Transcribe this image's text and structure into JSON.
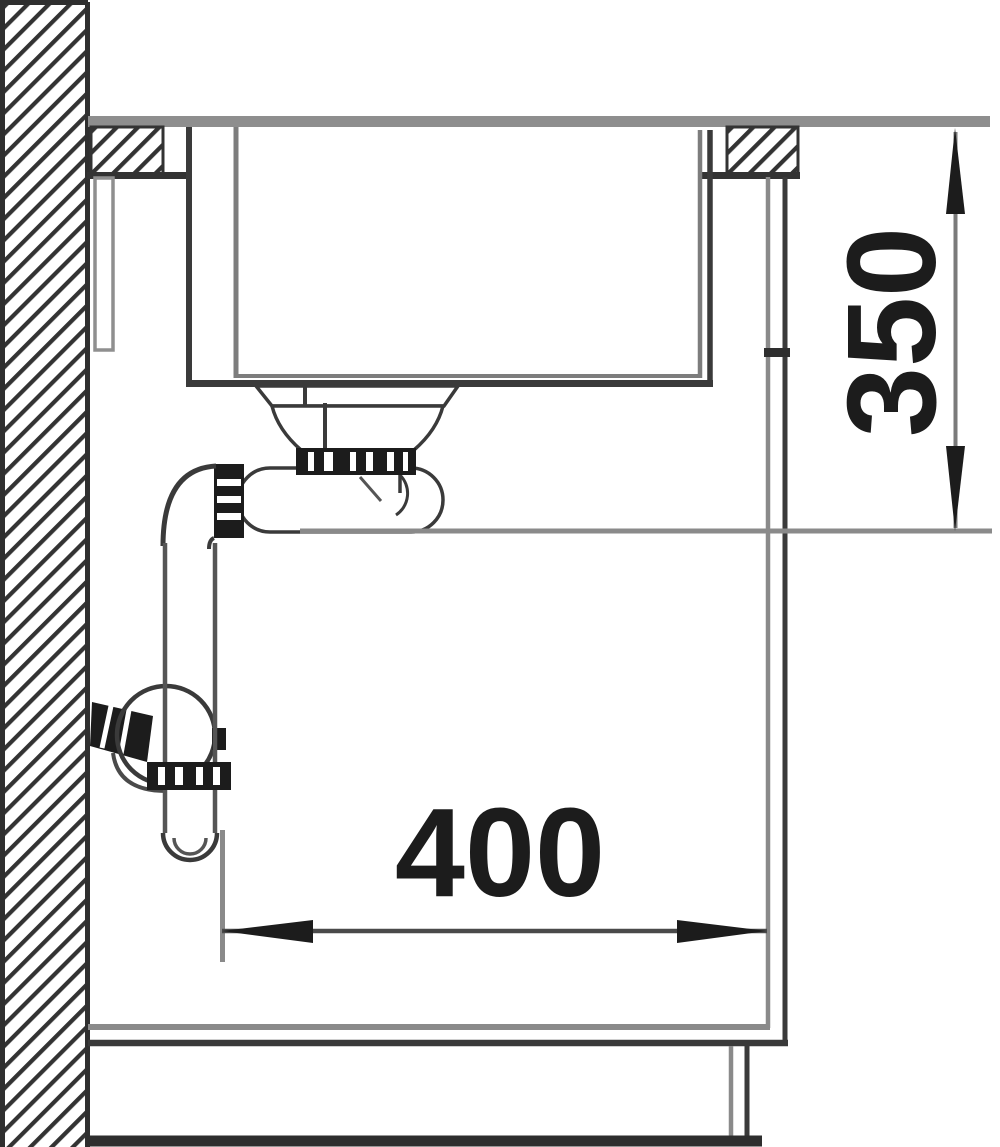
{
  "diagram": {
    "type": "sink-installation-cross-section",
    "dimension_vertical": {
      "label": "350"
    },
    "dimension_horizontal": {
      "label": "400"
    }
  },
  "colors": {
    "line_dark": "#3a3a3a",
    "line_gray": "#8a8a8a",
    "fill_black": "#1c1c1c",
    "surface_gray": "#8e8e8e",
    "background": "#ffffff"
  }
}
